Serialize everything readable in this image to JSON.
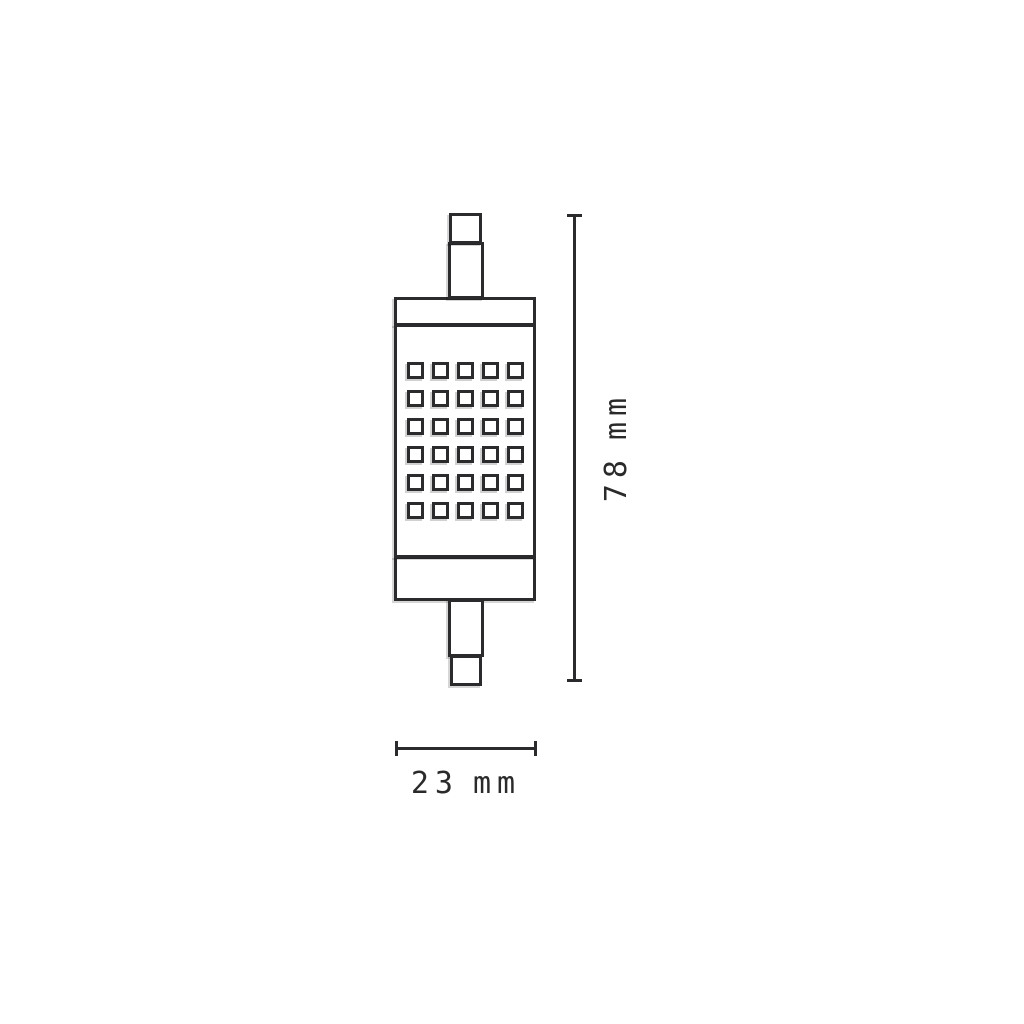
{
  "figure": {
    "subject": "r7s-led-lamp-dimensional-drawing",
    "colors": {
      "line": "#2b2b2e",
      "text": "#2a2a2a",
      "background": "#ffffff"
    },
    "led_grid": {
      "rows": 6,
      "columns": 5,
      "count": 30
    },
    "dimensions": {
      "height": {
        "value": "78",
        "unit": "mm"
      },
      "width": {
        "value": "23",
        "unit": "mm"
      }
    }
  }
}
